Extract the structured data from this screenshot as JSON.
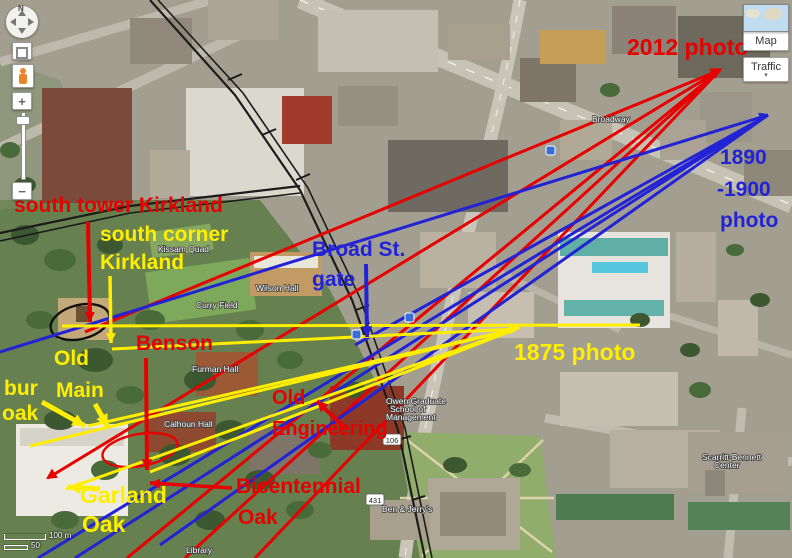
{
  "map_controls": {
    "north_label": "N",
    "zoom_in_label": "+",
    "zoom_out_label": "−"
  },
  "view_controls": {
    "map_label": "Map",
    "traffic_label": "Traffic",
    "caret": "▾"
  },
  "scale_bar": {
    "top": "100 m",
    "bottom": "50"
  },
  "colors": {
    "red": "#e60000",
    "blue": "#2323d6",
    "yellow": "#ffee00"
  },
  "sightlines": {
    "red": {
      "color": "#e60000",
      "width": 3,
      "origin": [
        720,
        70
      ],
      "ends": [
        [
          85,
          332
        ],
        [
          48,
          478
        ],
        [
          127,
          558
        ],
        [
          185,
          558
        ],
        [
          255,
          558
        ]
      ]
    },
    "blue": {
      "color": "#2323d6",
      "width": 3,
      "origin": [
        768,
        115
      ],
      "ends": [
        [
          0,
          352
        ],
        [
          38,
          558
        ],
        [
          75,
          558
        ],
        [
          160,
          545
        ],
        [
          355,
          345
        ]
      ]
    },
    "yellow": {
      "color": "#ffee00",
      "width": 3,
      "origin": [
        516,
        329
      ],
      "ends": [
        [
          112,
          349
        ],
        [
          88,
          426
        ],
        [
          30,
          446
        ],
        [
          66,
          489
        ],
        [
          150,
          472
        ]
      ],
      "segments": [
        [
          [
            62,
            326
          ],
          [
            640,
            325
          ]
        ]
      ]
    }
  },
  "arrowheads": [
    {
      "x": 722,
      "y": 68,
      "angle": -31,
      "color": "#e60000",
      "size": 13
    },
    {
      "x": 768,
      "y": 114,
      "angle": -20,
      "color": "#2323d6",
      "size": 10
    },
    {
      "x": 521,
      "y": 328,
      "angle": -2,
      "color": "#ffee00",
      "size": 13
    },
    {
      "x": 46,
      "y": 479,
      "angle": 147,
      "color": "#e60000",
      "size": 12
    }
  ],
  "arrows": [
    {
      "id": "south-tower-kirkland-arrow",
      "from": [
        88,
        222
      ],
      "to": [
        90,
        322
      ],
      "color": "#e60000",
      "width": 4,
      "head": 11
    },
    {
      "id": "south-corner-kirkland-arrow",
      "from": [
        110,
        276
      ],
      "to": [
        111,
        343
      ],
      "color": "#ffee00",
      "width": 3.5,
      "head": 11
    },
    {
      "id": "broad-st-gate-arrow",
      "from": [
        366,
        264
      ],
      "to": [
        367,
        337
      ],
      "color": "#2323d6",
      "width": 4,
      "head": 12
    },
    {
      "id": "benson-arrow",
      "from": [
        146,
        358
      ],
      "to": [
        147,
        470
      ],
      "color": "#e60000",
      "width": 4,
      "head": 12
    },
    {
      "id": "old-main-arrow",
      "from": [
        95,
        404
      ],
      "to": [
        108,
        427
      ],
      "color": "#ffee00",
      "width": 5,
      "head": 14
    },
    {
      "id": "bur-oak-arrow",
      "from": [
        42,
        402
      ],
      "to": [
        85,
        426
      ],
      "color": "#ffee00",
      "width": 5,
      "head": 14
    },
    {
      "id": "old-engineering-arrow",
      "from": [
        344,
        427
      ],
      "to": [
        317,
        401
      ],
      "color": "#e60000",
      "width": 4,
      "head": 12
    },
    {
      "id": "garland-oak-arrow",
      "from": [
        100,
        489
      ],
      "to": [
        68,
        487
      ],
      "color": "#ffee00",
      "width": 5,
      "head": 14
    },
    {
      "id": "bicentennial-oak-arrow",
      "from": [
        232,
        488
      ],
      "to": [
        150,
        483
      ],
      "color": "#e60000",
      "width": 3.5,
      "head": 11
    }
  ],
  "labels": [
    {
      "id": "label-south-tower-kirkland",
      "color": "#e60000",
      "size": 21,
      "lines": [
        {
          "t": "south tower Kirkland",
          "x": 14,
          "y": 212
        }
      ]
    },
    {
      "id": "label-south-corner-kirkland",
      "color": "#ffee00",
      "size": 21,
      "lines": [
        {
          "t": "south corner",
          "x": 100,
          "y": 241
        },
        {
          "t": "Kirkland",
          "x": 100,
          "y": 269
        }
      ]
    },
    {
      "id": "label-broad-st-gate",
      "color": "#2323d6",
      "size": 21,
      "lines": [
        {
          "t": "Broad St.",
          "x": 312,
          "y": 256
        },
        {
          "t": "gate",
          "x": 312,
          "y": 286
        }
      ]
    },
    {
      "id": "label-benson",
      "color": "#e60000",
      "size": 21,
      "lines": [
        {
          "t": "Benson",
          "x": 136,
          "y": 350
        }
      ]
    },
    {
      "id": "label-old-main",
      "color": "#ffee00",
      "size": 21,
      "lines": [
        {
          "t": "Old",
          "x": 54,
          "y": 365
        },
        {
          "t": "Main",
          "x": 56,
          "y": 397
        }
      ]
    },
    {
      "id": "label-bur-oak",
      "color": "#ffee00",
      "size": 21,
      "lines": [
        {
          "t": "bur",
          "x": 4,
          "y": 395
        },
        {
          "t": "oak",
          "x": 2,
          "y": 420
        }
      ]
    },
    {
      "id": "label-old-engineering",
      "color": "#e60000",
      "size": 20,
      "lines": [
        {
          "t": "Old",
          "x": 272,
          "y": 404
        },
        {
          "t": "Engineering",
          "x": 272,
          "y": 435
        }
      ]
    },
    {
      "id": "label-garland-oak",
      "color": "#ffee00",
      "size": 23,
      "lines": [
        {
          "t": "Garland",
          "x": 80,
          "y": 503
        },
        {
          "t": "Oak",
          "x": 82,
          "y": 532
        }
      ]
    },
    {
      "id": "label-bicentennial-oak",
      "color": "#e60000",
      "size": 21,
      "lines": [
        {
          "t": "Bicentennial",
          "x": 236,
          "y": 493
        },
        {
          "t": "Oak",
          "x": 238,
          "y": 524
        }
      ]
    },
    {
      "id": "label-2012-photo",
      "color": "#e60000",
      "size": 23,
      "lines": [
        {
          "t": "2012 photo",
          "x": 627,
          "y": 55
        }
      ]
    },
    {
      "id": "label-1890-1900-photo",
      "color": "#2323d6",
      "size": 21,
      "lines": [
        {
          "t": "1890",
          "x": 720,
          "y": 164
        },
        {
          "t": "-1900",
          "x": 717,
          "y": 196
        },
        {
          "t": "photo",
          "x": 720,
          "y": 227
        }
      ]
    },
    {
      "id": "label-1875-photo",
      "color": "#ffee00",
      "size": 23,
      "lines": [
        {
          "t": "1875 photo",
          "x": 514,
          "y": 360
        }
      ]
    }
  ],
  "map_labels": [
    {
      "t": "Curry Field",
      "x": 196,
      "y": 308
    },
    {
      "t": "Wilson Hall",
      "x": 256,
      "y": 291
    },
    {
      "t": "Kissam Quad",
      "x": 158,
      "y": 252
    },
    {
      "t": "Furman Hall",
      "x": 192,
      "y": 372
    },
    {
      "t": "Calhoun Hall",
      "x": 164,
      "y": 427
    },
    {
      "t": "Owen Graduate",
      "x": 386,
      "y": 404
    },
    {
      "t": "School of",
      "x": 390,
      "y": 412
    },
    {
      "t": "Management",
      "x": 386,
      "y": 420
    },
    {
      "t": "Library",
      "x": 186,
      "y": 553
    },
    {
      "t": "Ben & Jerry's",
      "x": 382,
      "y": 512
    },
    {
      "t": "Scarritt-Bennett",
      "x": 702,
      "y": 460
    },
    {
      "t": "Center",
      "x": 714,
      "y": 468
    },
    {
      "t": "Broadway",
      "x": 592,
      "y": 122
    }
  ],
  "route_shields": [
    {
      "t": "106",
      "x": 392,
      "y": 441
    },
    {
      "t": "431",
      "x": 375,
      "y": 501
    }
  ],
  "map_icons": [
    {
      "name": "transit-icon",
      "x": 352,
      "y": 330
    },
    {
      "name": "transit-icon",
      "x": 405,
      "y": 313
    },
    {
      "name": "transit-icon",
      "x": 546,
      "y": 146
    }
  ]
}
